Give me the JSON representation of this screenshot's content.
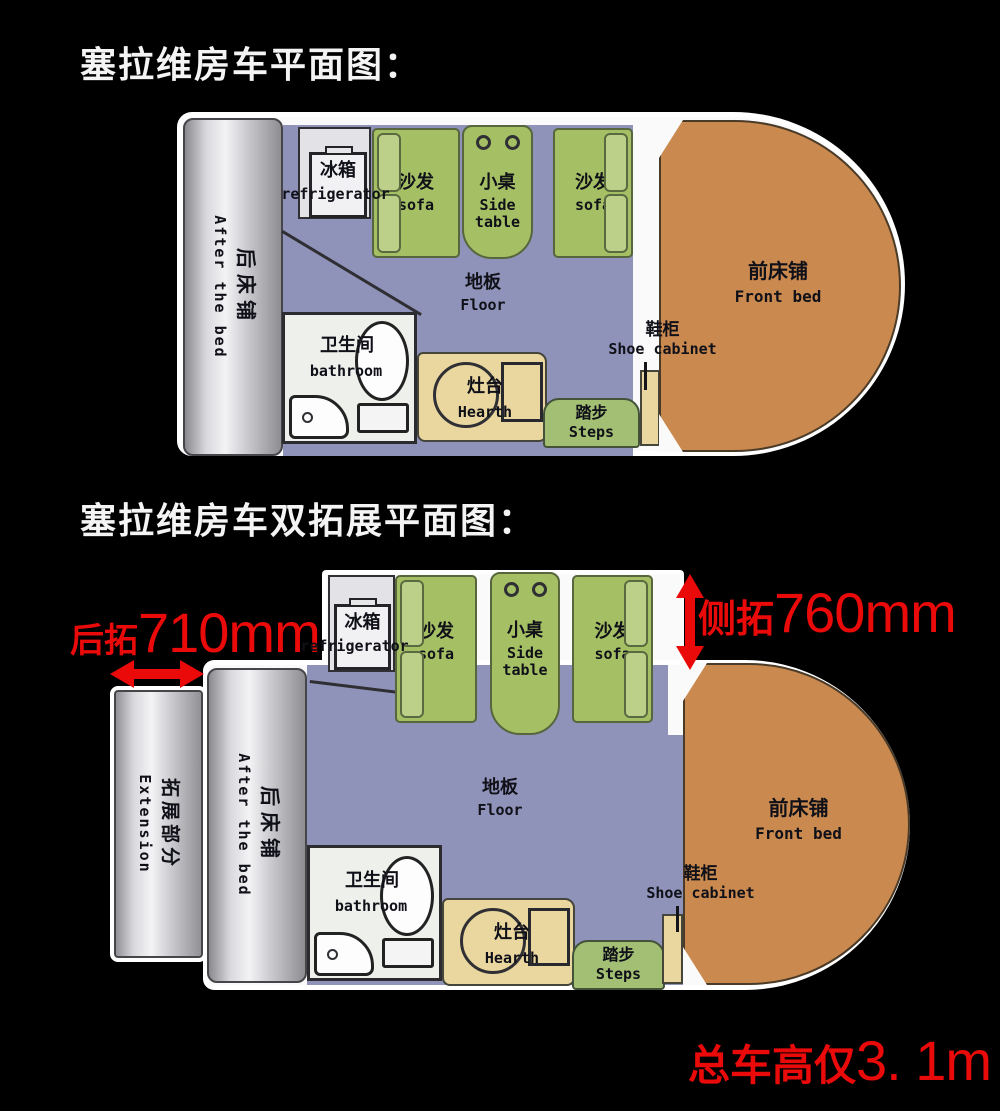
{
  "colors": {
    "background": "#000000",
    "title_text": "#f4f4f4",
    "dimension_red": "#ea0a0a",
    "body_white": "#fafafa",
    "floor_purple": "#9093b9",
    "sofa_green": "#a5c064",
    "sofa_arm_green": "#bdd08a",
    "steps_green": "#a2bf74",
    "front_bed_orange": "#c9894f",
    "cabinet_tan": "#e9d79f",
    "bed_silver": "#d9d9dd",
    "bathroom_white": "#eef0ec",
    "wall_dark": "#2f2f34"
  },
  "titles": {
    "plan1": "塞拉维房车平面图：",
    "plan2": "塞拉维房车双拓展平面图："
  },
  "rooms": {
    "rear_bed": {
      "zh": "后床铺",
      "en": "After the bed"
    },
    "extension": {
      "zh": "拓展部分",
      "en": "Extension"
    },
    "fridge": {
      "zh": "冰箱",
      "en": "refrigerator"
    },
    "sofa": {
      "zh": "沙发",
      "en": "sofa"
    },
    "side_table": {
      "zh": "小桌",
      "en": "Side\ntable"
    },
    "floor": {
      "zh": "地板",
      "en": "Floor"
    },
    "bathroom": {
      "zh": "卫生间",
      "en": "bathroom"
    },
    "hearth": {
      "zh": "灶台",
      "en": "Hearth"
    },
    "steps": {
      "zh": "踏步",
      "en": "Steps"
    },
    "shoe_cabinet": {
      "zh": "鞋柜",
      "en": "Shoe cabinet"
    },
    "front_bed": {
      "zh": "前床铺",
      "en": "Front bed"
    }
  },
  "annotations": {
    "rear_extension": {
      "label": "后拓",
      "value": "710mm"
    },
    "side_extension": {
      "label": "侧拓",
      "value": "760mm"
    },
    "total_height": {
      "label": "总车高仅",
      "value": "3. 1m"
    }
  }
}
